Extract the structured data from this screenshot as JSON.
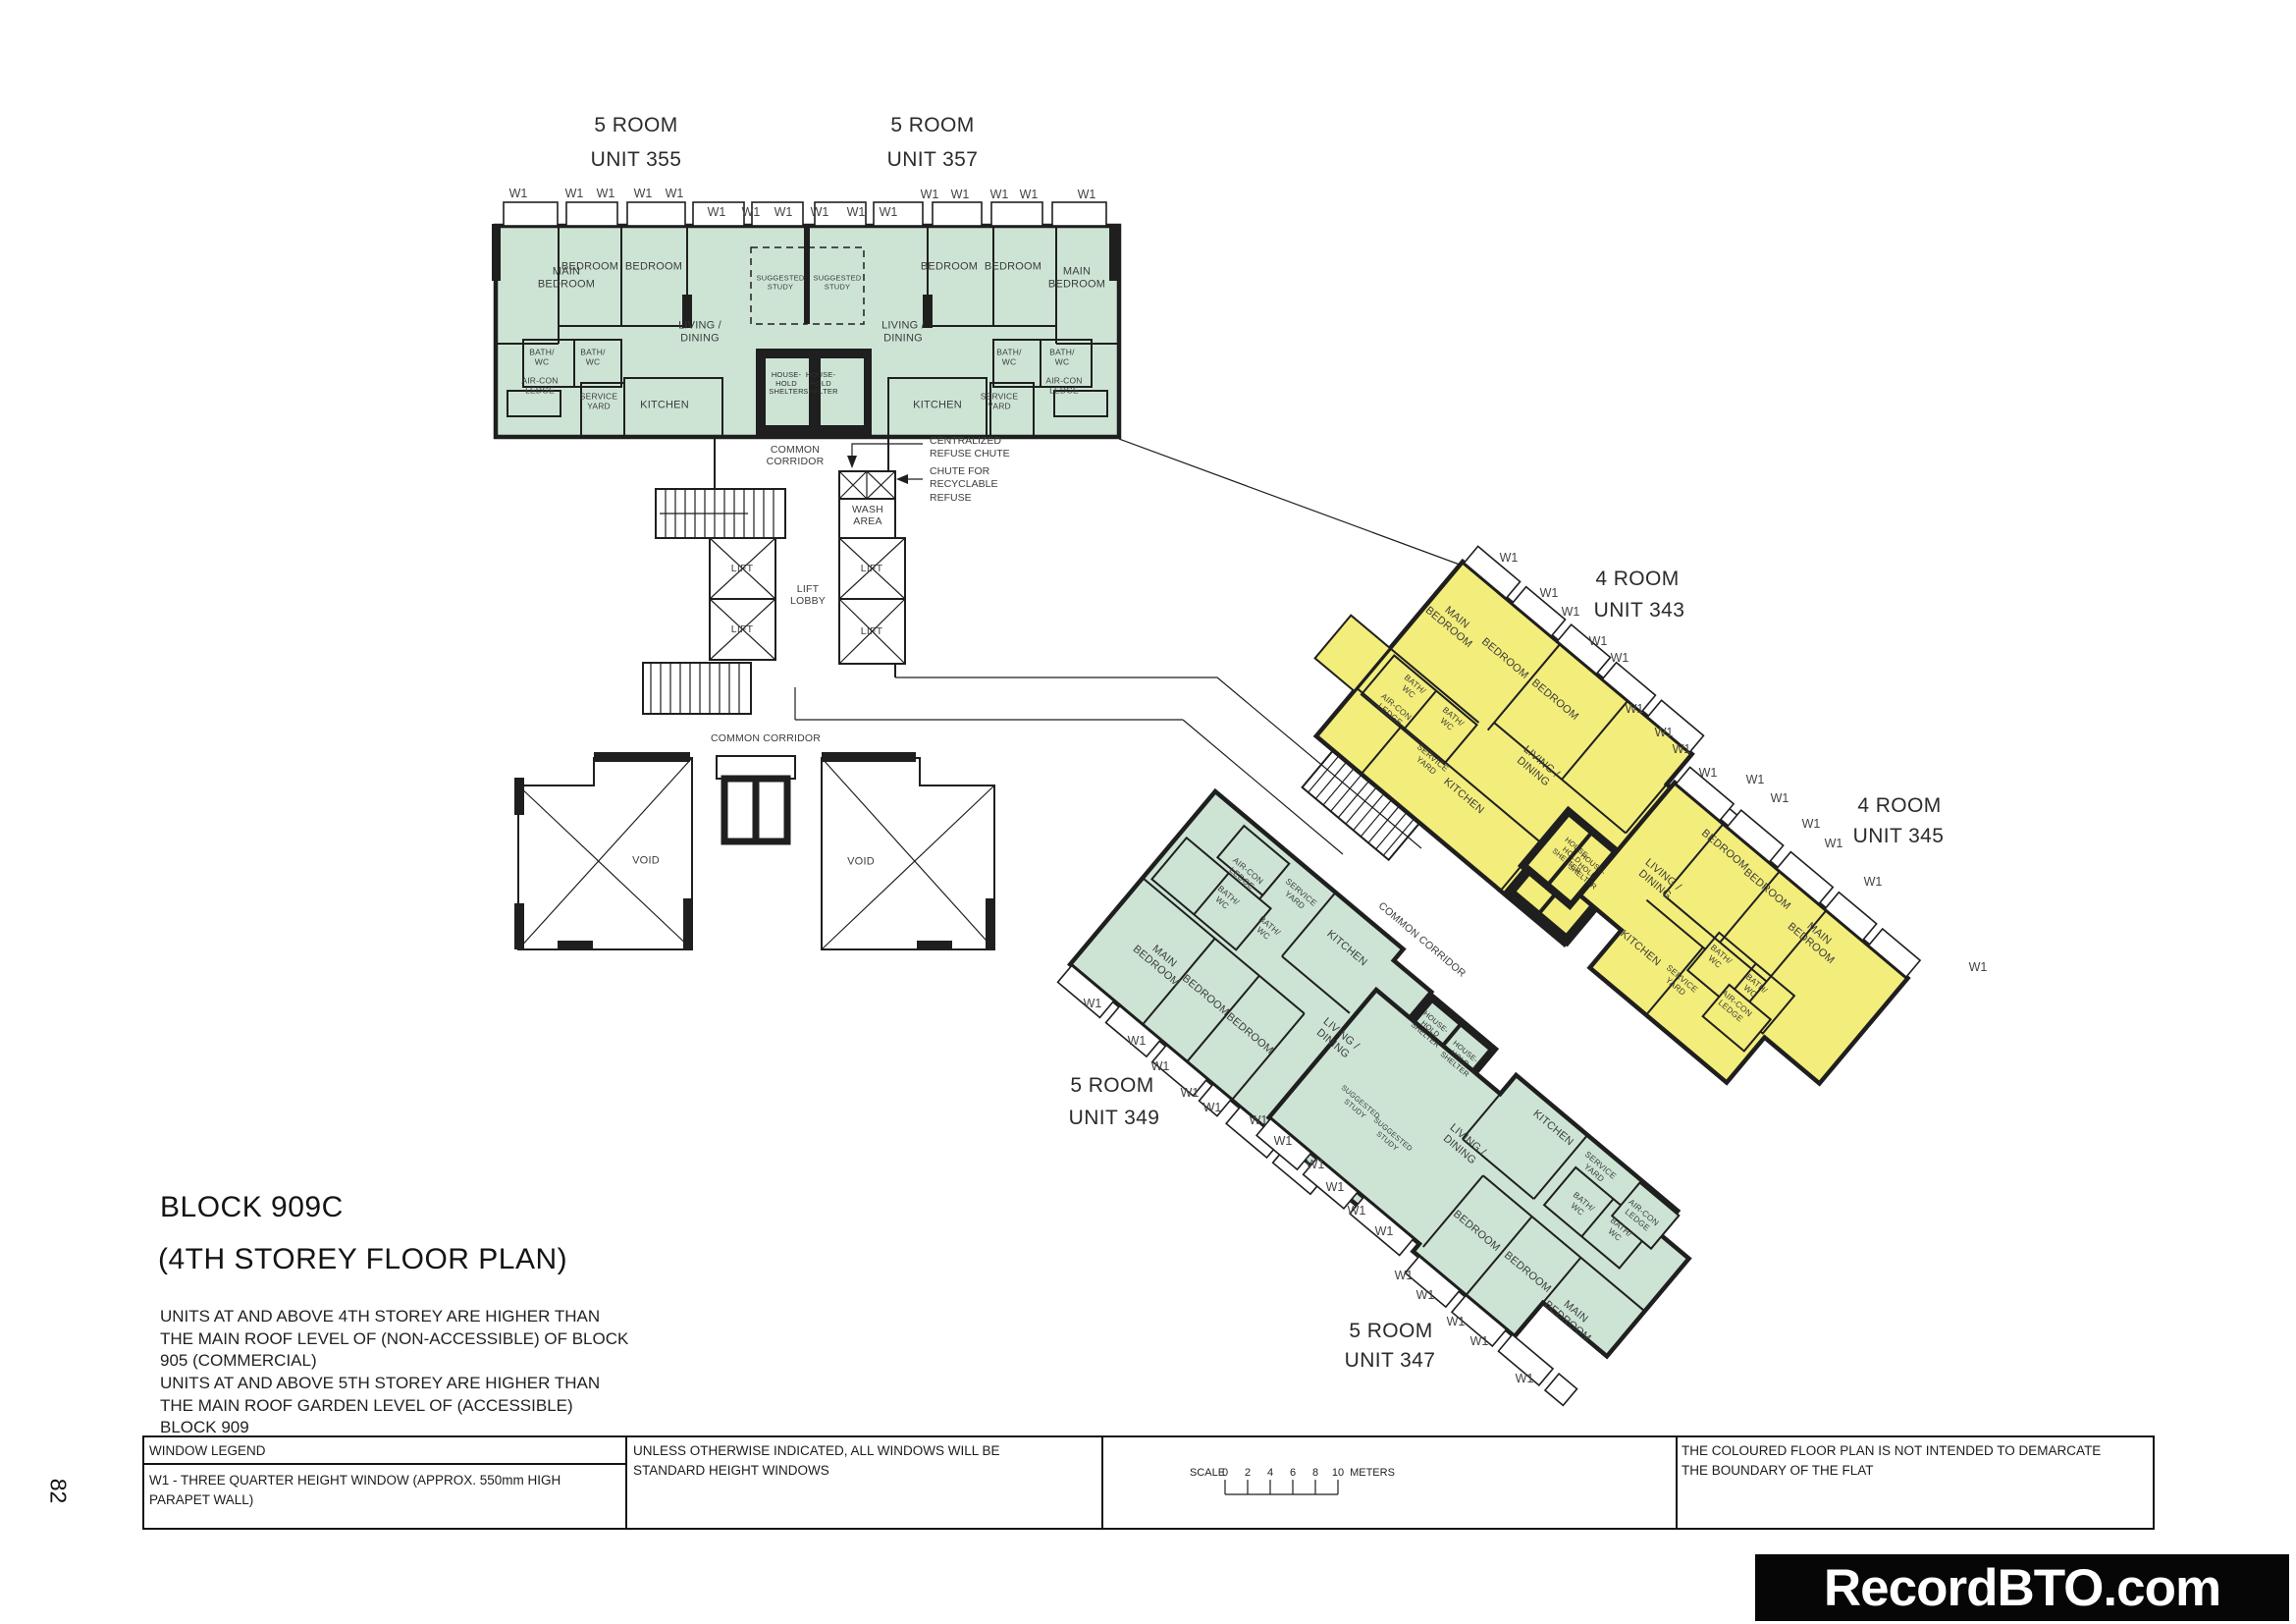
{
  "page_number": "82",
  "brand": {
    "site_name": "RecordBTO.com"
  },
  "plan": {
    "title": "BLOCK 909C",
    "subtitle": "(4TH STOREY FLOOR PLAN)",
    "note_1": "UNITS AT AND ABOVE 4TH STOREY ARE HIGHER THAN THE MAIN ROOF LEVEL OF (NON-ACCESSIBLE) OF BLOCK 905 (COMMERCIAL)",
    "note_2": "UNITS AT AND ABOVE 5TH STOREY ARE HIGHER THAN THE MAIN ROOF GARDEN LEVEL OF (ACCESSIBLE) BLOCK 909"
  },
  "units": {
    "u355": {
      "type": "5 ROOM",
      "label": "UNIT 355"
    },
    "u357": {
      "type": "5 ROOM",
      "label": "UNIT 357"
    },
    "u343": {
      "type": "4 ROOM",
      "label": "UNIT 343"
    },
    "u345": {
      "type": "4 ROOM",
      "label": "UNIT 345"
    },
    "u349": {
      "type": "5 ROOM",
      "label": "UNIT 349"
    },
    "u347": {
      "type": "5 ROOM",
      "label": "UNIT 347"
    }
  },
  "rooms": {
    "main_bedroom": "MAIN BEDROOM",
    "bedroom": "BEDROOM",
    "living_dining": "LIVING / DINING",
    "kitchen": "KITCHEN",
    "bath_wc": "BATH/ WC",
    "service_yard": "SERVICE YARD",
    "aircon_ledge": "AIR-CON LEDGE",
    "household_shelter": "HOUSE- HOLD SHELTER",
    "suggested_study": "SUGGESTED STUDY",
    "wash_area": "WASH AREA",
    "lift": "LIFT",
    "lift_lobby": "LIFT LOBBY",
    "common_corridor": "COMMON CORRIDOR",
    "void": "VOID"
  },
  "annotations": {
    "w1": "W1",
    "centralized_refuse_chute": "CENTRALIZED REFUSE CHUTE",
    "chute_recyclable": "CHUTE FOR RECYCLABLE REFUSE"
  },
  "legend": {
    "window_legend_title": "WINDOW LEGEND",
    "w1_description": "W1 - THREE QUARTER HEIGHT WINDOW (APPROX. 550mm HIGH PARAPET WALL)",
    "windows_note": "UNLESS OTHERWISE INDICATED, ALL WINDOWS WILL BE STANDARD HEIGHT WINDOWS",
    "boundary_note": "THE COLOURED FLOOR PLAN IS NOT INTENDED TO DEMARCATE THE BOUNDARY OF THE FLAT"
  },
  "scale_bar": {
    "label": "SCALE",
    "ticks": [
      "0",
      "2",
      "4",
      "6",
      "8",
      "10"
    ],
    "unit": "METERS"
  },
  "colors": {
    "five_room_fill": "#cde4d5",
    "four_room_fill": "#f3ed7b",
    "wall": "#1f1f1f"
  }
}
